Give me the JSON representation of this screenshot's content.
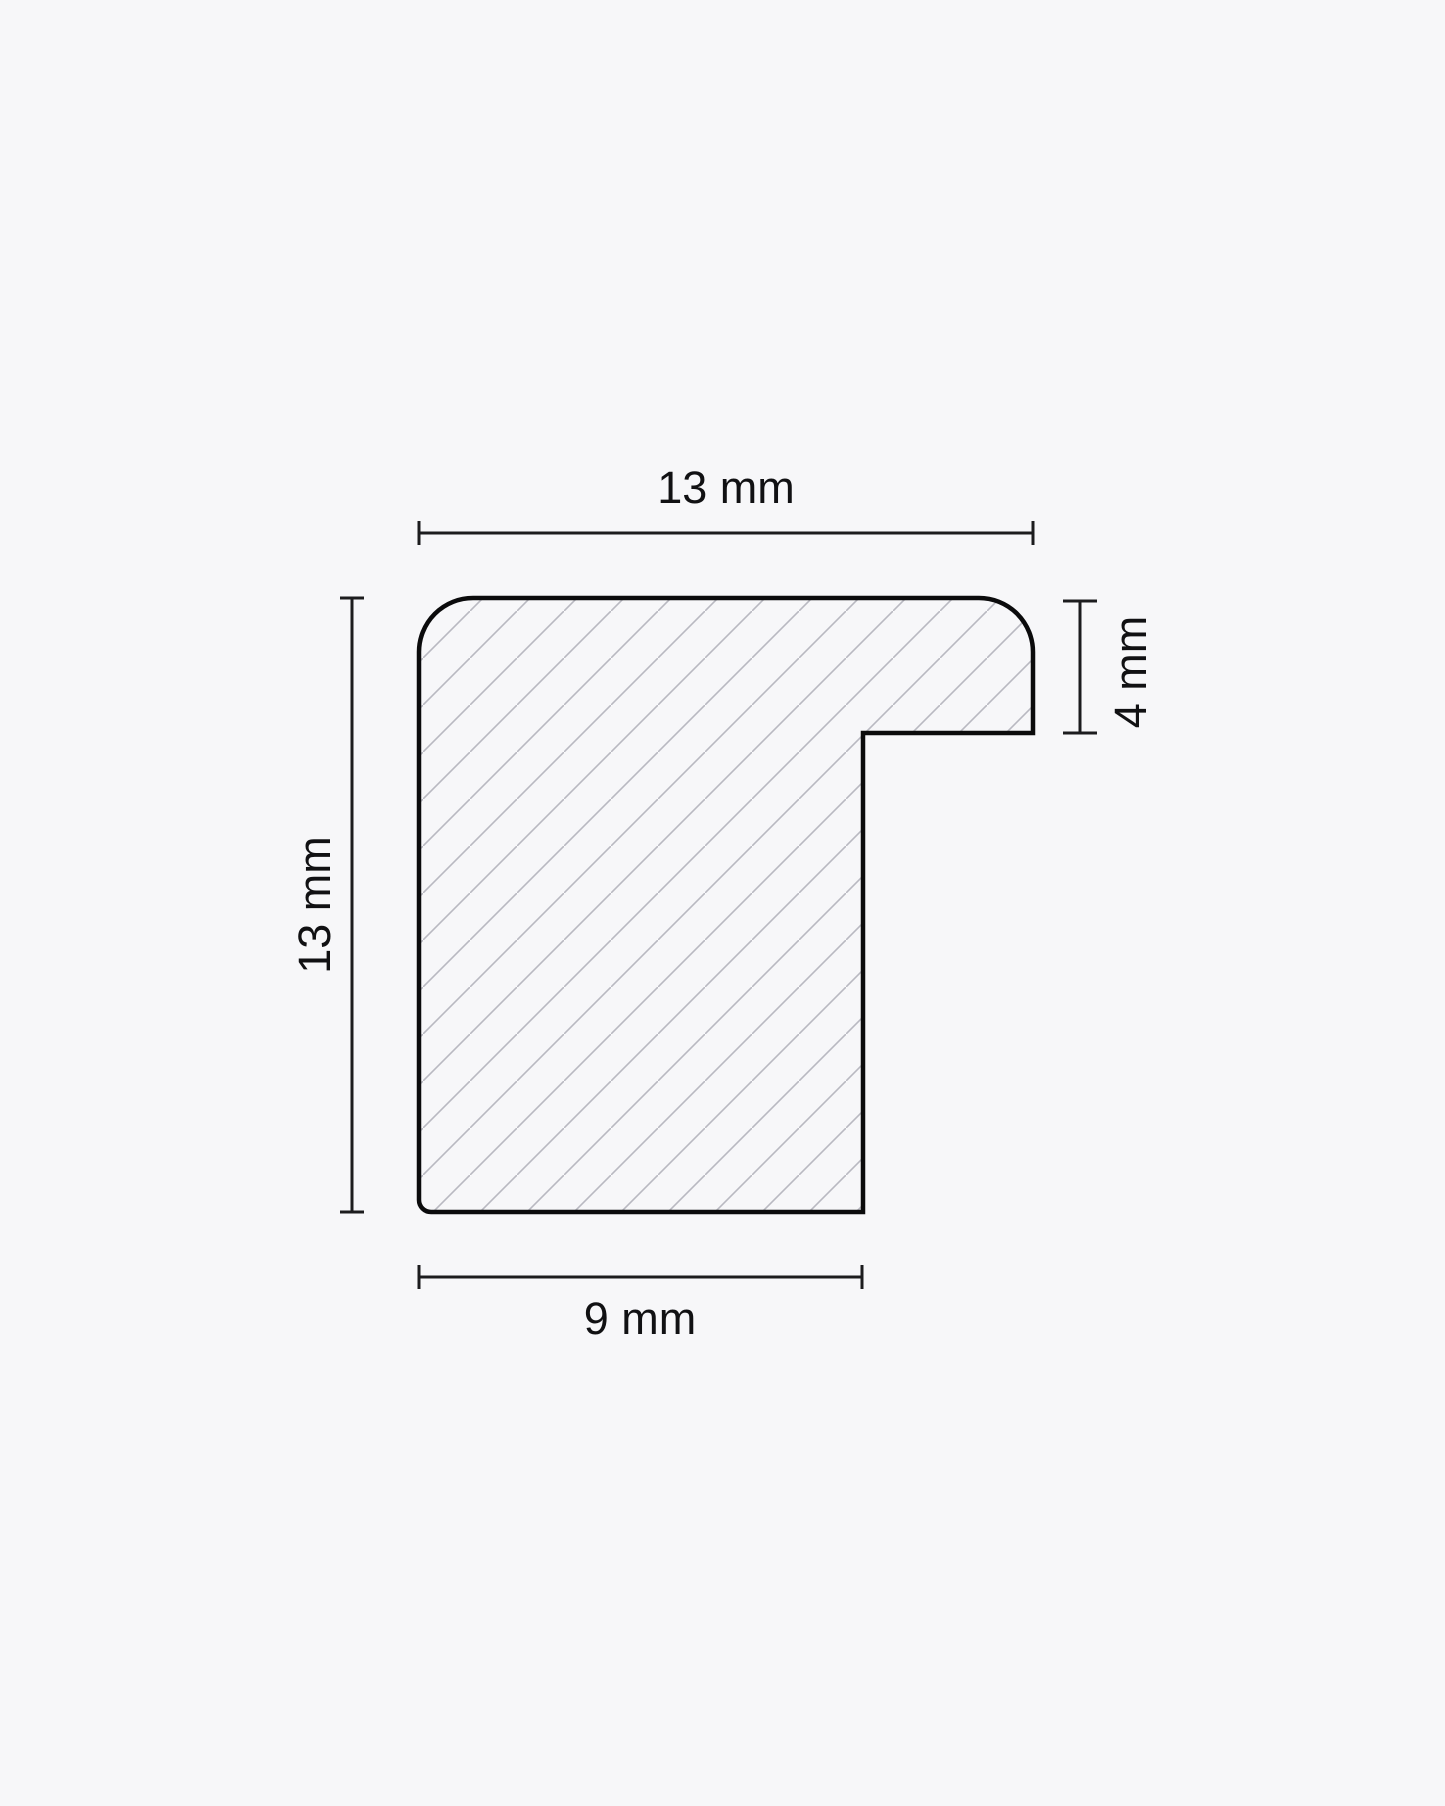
{
  "diagram": {
    "type": "technical-cross-section",
    "dimensions": {
      "top_width": {
        "label": "13 mm",
        "value": 13,
        "unit": "mm",
        "side": "top"
      },
      "left_height": {
        "label": "13 mm",
        "value": 13,
        "unit": "mm",
        "side": "left"
      },
      "right_rebate_depth": {
        "label": "4 mm",
        "value": 4,
        "unit": "mm",
        "side": "right"
      },
      "bottom_width": {
        "label": "9 mm",
        "value": 9,
        "unit": "mm",
        "side": "bottom"
      }
    },
    "colors": {
      "background": "#f7f7f9",
      "outline": "#0b0b0c",
      "dimension_lines": "#1c1c1e",
      "hatch_lines": "#b9b9c1",
      "label_text": "#111113"
    }
  }
}
